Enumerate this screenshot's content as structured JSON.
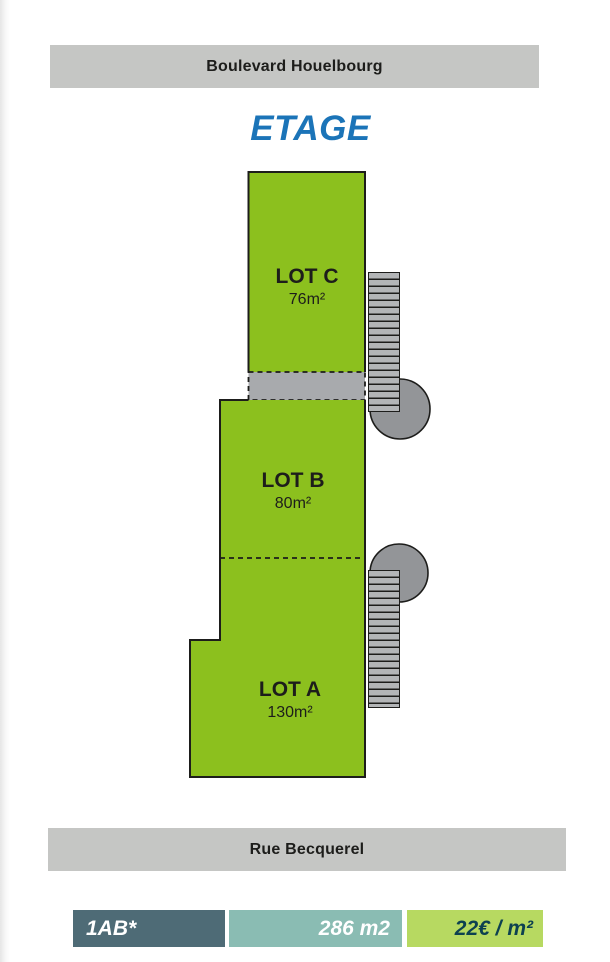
{
  "title": "ETAGE",
  "streets": {
    "top": "Boulevard Houelbourg",
    "bottom": "Rue Becquerel"
  },
  "lots": [
    {
      "name": "LOT C",
      "area": "76m²"
    },
    {
      "name": "LOT B",
      "area": "80m²"
    },
    {
      "name": "LOT A",
      "area": "130m²"
    }
  ],
  "legend": {
    "reference": "1AB*",
    "total_area": "286 m2",
    "price": "22€ / m²"
  },
  "colors": {
    "lot_green": "#8cc01e",
    "corridor_gray": "#a8aaad",
    "street_bar_gray": "#c5c6c4",
    "title_blue": "#1b74b8",
    "stair_gray": "#b3b5b7",
    "landing_circle_gray": "#939598",
    "legend_reference_bg": "#4e6b76",
    "legend_area_bg": "#8abcb3",
    "legend_price_bg": "#b7d961",
    "legend_price_text": "#0d4150"
  }
}
